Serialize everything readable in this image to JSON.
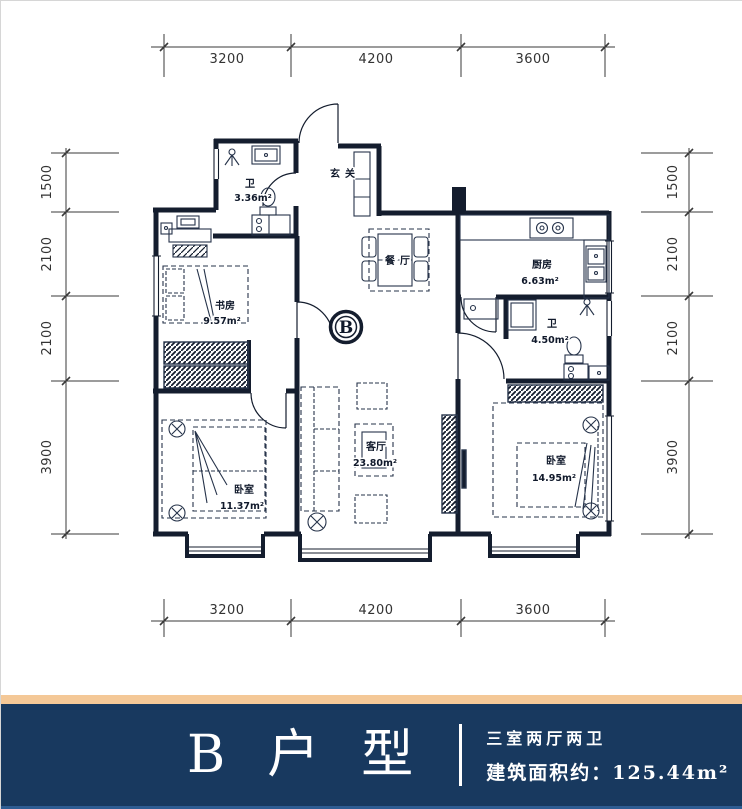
{
  "plan": {
    "dims_top": [
      "3200",
      "4200",
      "3600"
    ],
    "dims_bottom": [
      "3200",
      "4200",
      "3600"
    ],
    "dims_left": [
      "1500",
      "2100",
      "2100",
      "3900"
    ],
    "dims_right": [
      "1500",
      "2100",
      "2100",
      "3900"
    ],
    "unit_marker": "B",
    "rooms": {
      "entry": "玄关",
      "dining": "餐厅",
      "kitchen": "厨房",
      "kitchen_area": "6.63m²",
      "bath_top": "卫",
      "bath_top_area": "3.36m²",
      "bath_right": "卫",
      "bath_right_area": "4.50m²",
      "study": "书房",
      "study_area": "9.57m²",
      "living": "客厅",
      "living_area": "23.80m²",
      "bedroom_left": "卧室",
      "bedroom_left_area": "11.37m²",
      "bedroom_right": "卧室",
      "bedroom_right_area": "14.95m²"
    }
  },
  "footer": {
    "title": "B户型",
    "line1": "三室两厅两卫",
    "line2": "建筑面积约：125.44m²",
    "colors": {
      "band": "#18395f",
      "stripe": "#f4c897",
      "accent": "#2e5c92",
      "line": "#141d2e"
    }
  }
}
